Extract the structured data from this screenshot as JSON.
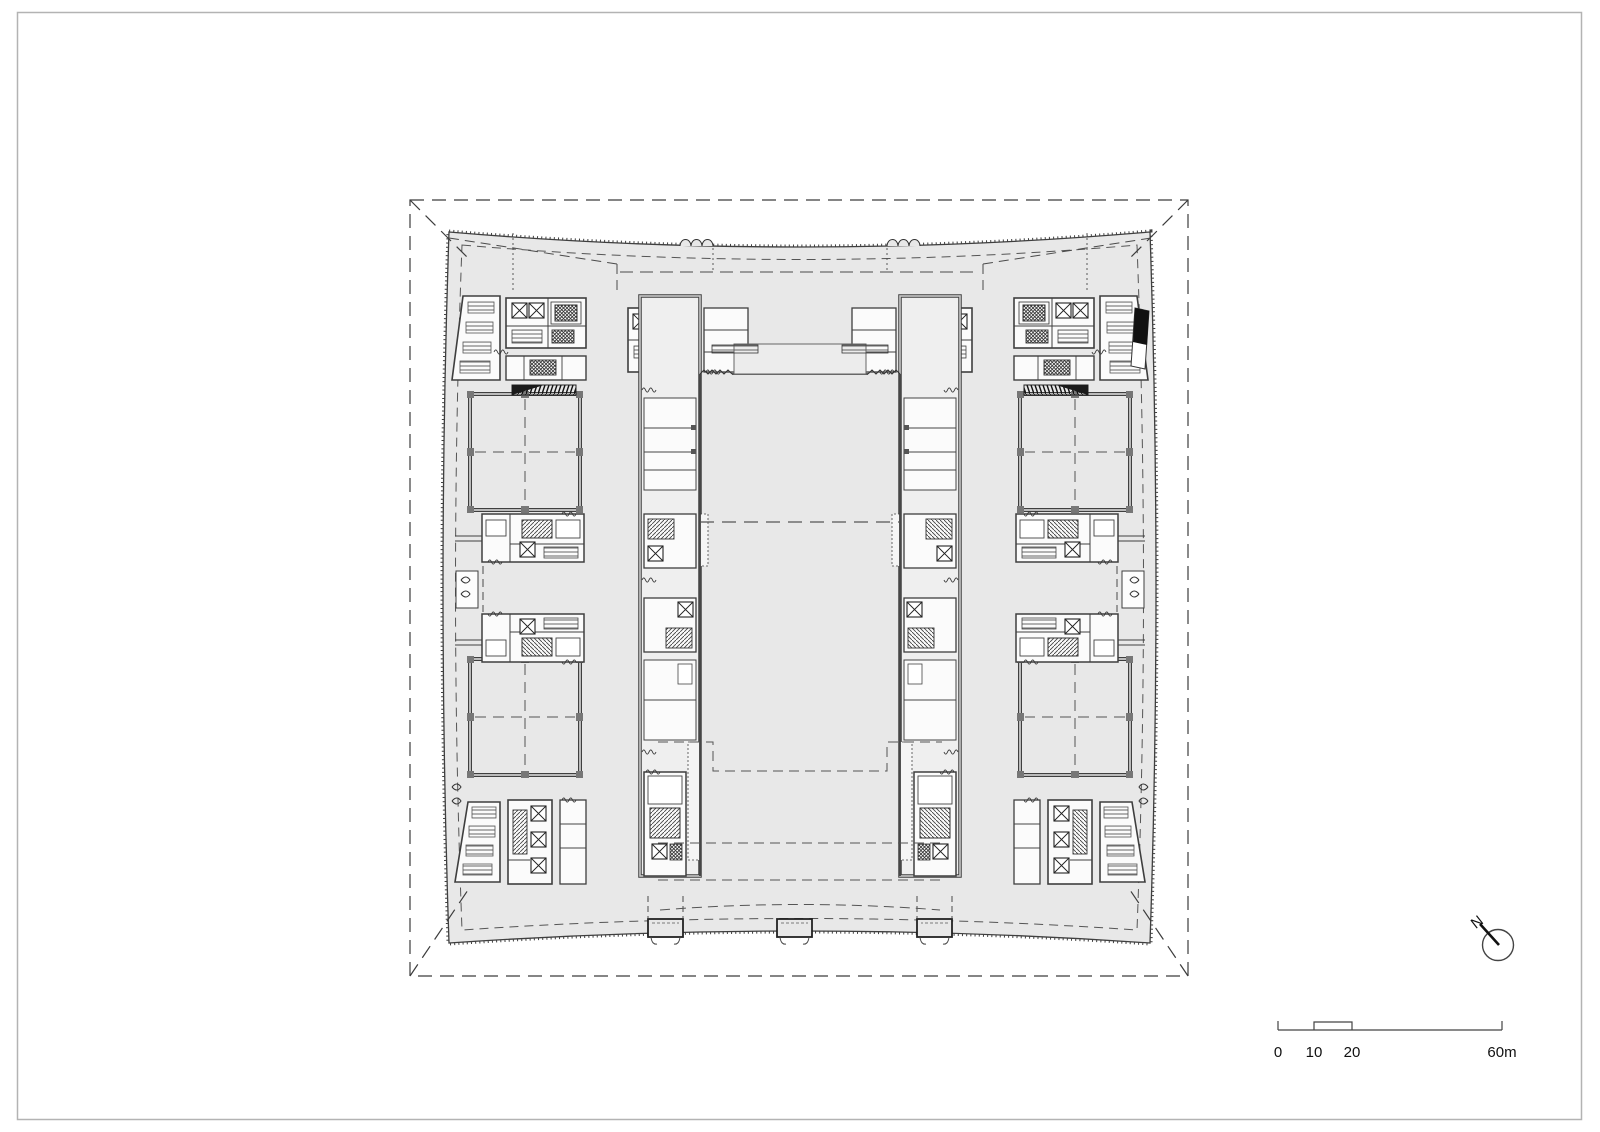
{
  "sheet": {
    "background": "#ffffff",
    "border_color": "#b3b3b3"
  },
  "plan": {
    "type": "architectural-floor-plan",
    "plate_fill": "#e8e8e8",
    "wall_color": "#3f3f3f",
    "dash_color": "#4a4a4a",
    "room_fill": "#fbfbfb",
    "accent_black": "#111111"
  },
  "scale_bar": {
    "labels": [
      "0",
      "10",
      "20",
      "60m"
    ],
    "values_m": [
      0,
      10,
      20,
      60
    ]
  },
  "north_arrow": {
    "label": "N"
  }
}
